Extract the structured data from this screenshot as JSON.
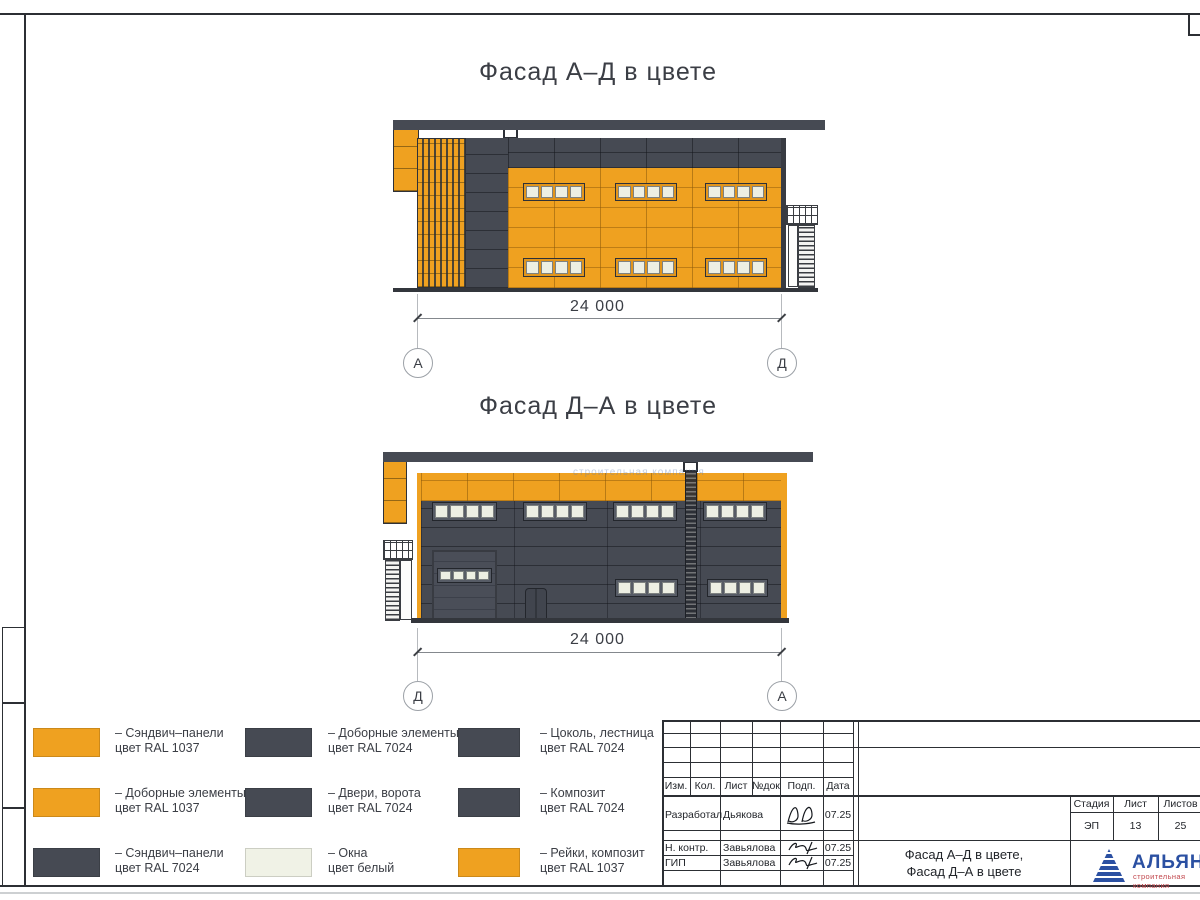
{
  "drawing": {
    "facade1_title": "Фасад А–Д в цвете",
    "facade2_title": "Фасад Д–А в цвете",
    "dim1": "24 000",
    "dim2": "24 000",
    "axis1_left": "А",
    "axis1_right": "Д",
    "axis2_left": "Д",
    "axis2_right": "А",
    "watermark": "строительная компания"
  },
  "legend": {
    "items": [
      {
        "swatch_color": "#EFA120",
        "line1": "– Сэндвич–панели",
        "line2": "цвет RAL 1037"
      },
      {
        "swatch_color": "#EFA120",
        "line1": "– Доборные элементы",
        "line2": "цвет RAL 1037"
      },
      {
        "swatch_color": "#464A53",
        "line1": "– Сэндвич–панели",
        "line2": "цвет RAL 7024"
      },
      {
        "swatch_color": "#464A53",
        "line1": "– Доборные элементы",
        "line2": "цвет RAL 7024"
      },
      {
        "swatch_color": "#464A53",
        "line1": "– Двери, ворота",
        "line2": "цвет RAL 7024"
      },
      {
        "swatch_color": "#F0F2E6",
        "line1": "– Окна",
        "line2": "цвет белый"
      },
      {
        "swatch_color": "#464A53",
        "line1": "– Цоколь, лестница",
        "line2": "цвет RAL 7024"
      },
      {
        "swatch_color": "#464A53",
        "line1": "– Композит",
        "line2": "цвет RAL 7024"
      },
      {
        "swatch_color": "#EFA120",
        "line1": "– Рейки, композит",
        "line2": "цвет RAL 1037"
      }
    ]
  },
  "titleblock": {
    "header_cells": [
      "Изм.",
      "Кол.",
      "Лист",
      "№док",
      "Подп.",
      "Дата"
    ],
    "rows": [
      {
        "role": "Разработал",
        "name": "Дьякова",
        "date": "07.25"
      },
      {
        "role": "Н. контр.",
        "name": "Завьялова",
        "date": "07.25"
      },
      {
        "role": "ГИП",
        "name": "Завьялова",
        "date": "07.25"
      }
    ],
    "stage_label": "Стадия",
    "sheet_label": "Лист",
    "sheets_label": "Листов",
    "stage_value": "ЭП",
    "sheet_value": "13",
    "sheets_value": "25",
    "doc_title_line1": "Фасад А–Д в цвете,",
    "doc_title_line2": "Фасад Д–А в цвете"
  },
  "logo": {
    "name": "АЛЬЯНС",
    "subtitle": "строительная компания",
    "color": "#2b50a2",
    "subtitle_color": "#c2484e"
  },
  "colors": {
    "orange_ral1037": "#EFA120",
    "dark_ral7024": "#464A53",
    "window_white": "#EDEFE3"
  }
}
